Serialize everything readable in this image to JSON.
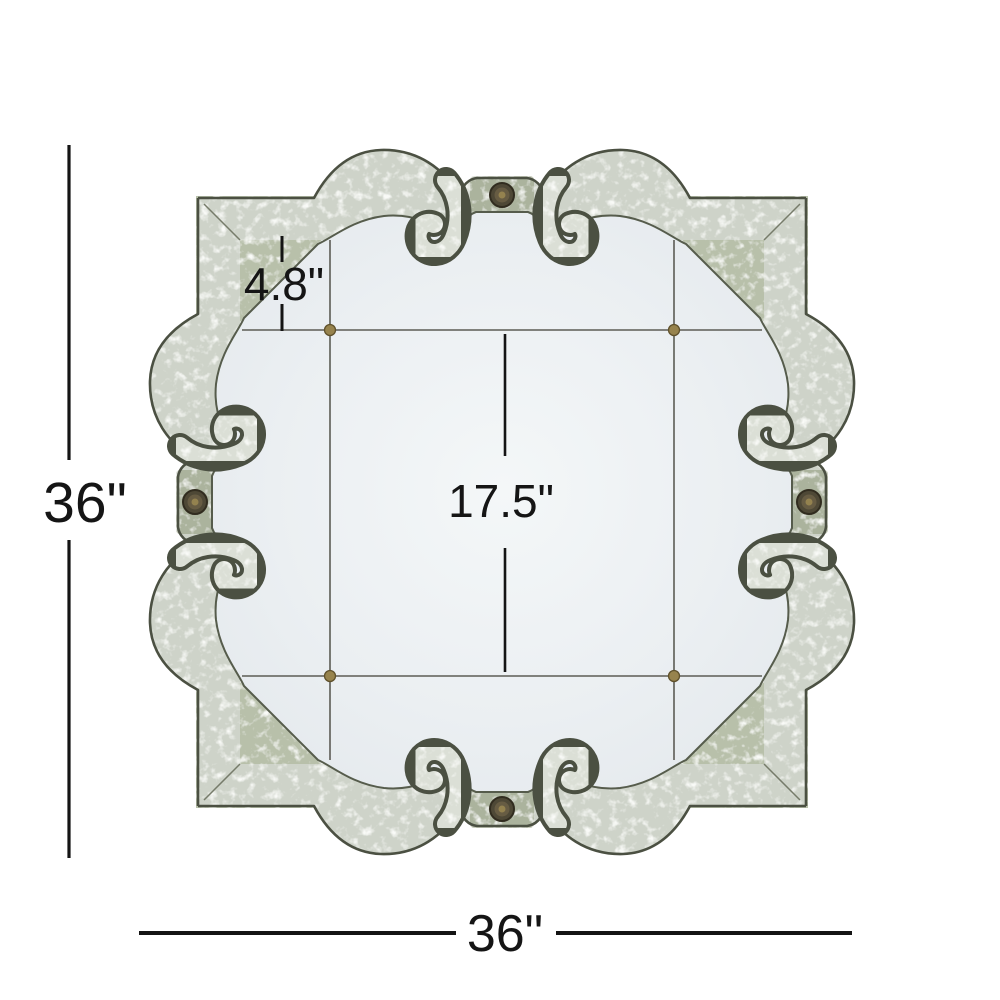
{
  "diagram": {
    "dimensions": {
      "height": "36\"",
      "width": "36\"",
      "center_panel": "17.5\"",
      "border_panel": "4.8\""
    },
    "colors": {
      "dimension_line": "#141414",
      "frame_mirror": "#ced3c9",
      "frame_green": "#96a086",
      "frame_edge": "#4b5042",
      "glass": "#eaeef1",
      "brass_pin": "#97834d",
      "medallion_bronze": "#4e4836"
    }
  }
}
